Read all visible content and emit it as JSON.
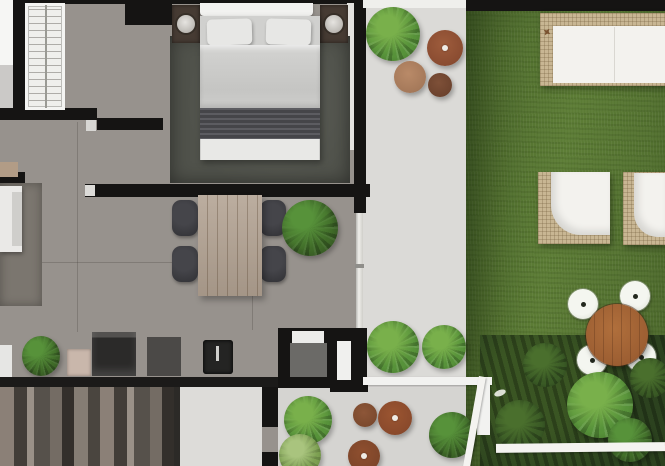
{
  "scene": {
    "type": "architectural-floor-plan-render",
    "view": "top-down",
    "rooms": [
      "bedroom",
      "living-dining",
      "kitchen",
      "bathroom",
      "stairwell",
      "patio",
      "garden-lawn",
      "planting-bed"
    ],
    "objects": [
      "wardrobe-with-shelves",
      "double-bed",
      "pillow-left",
      "pillow-right",
      "striped-blanket",
      "nightstand-left",
      "nightstand-right",
      "bedside-lamp-left",
      "bedside-lamp-right",
      "bedroom-rug",
      "dining-table",
      "dining-chairs-x4",
      "indoor-plant",
      "living-sofa",
      "living-rug",
      "kitchen-counter",
      "fridge",
      "cooktop",
      "oven",
      "appliance-box",
      "kitchen-sink-with-faucet",
      "staircase",
      "bathroom-pod",
      "bathroom-sink",
      "bathroom-door",
      "patio-plant-large",
      "patio-side-table-red",
      "patio-side-table-tan",
      "patio-side-table-small",
      "garden-daybed",
      "garden-armchair-left",
      "garden-armchair-right",
      "round-garden-table",
      "garden-chairs-x4",
      "white-railing",
      "white-fence",
      "shrubs",
      "lawn"
    ]
  },
  "colors": {
    "wall": "#151413",
    "floor": "#97928d",
    "patio": "#dbdad7",
    "white": "#f1f0ee",
    "grass": "#5d7d36",
    "grassDark": "#4c682c",
    "rugBedroom": "#50524b",
    "rugLiving": "#7b766f",
    "wood": "#b2a292",
    "woodRound": "#9c5e32",
    "wicker": "#c8b693",
    "cushion": "#f3f2ee",
    "chairDark": "#313135",
    "plantMid": "#3f6a28",
    "plantBright": "#57923a",
    "plantDark": "#2c421f",
    "tableBrownRed": "#8a4c31",
    "tableBrownTan": "#a5795a",
    "tableBrownDark": "#6d432e",
    "counter": "#1b1a19",
    "bedLinen": "#d0d0ce"
  }
}
